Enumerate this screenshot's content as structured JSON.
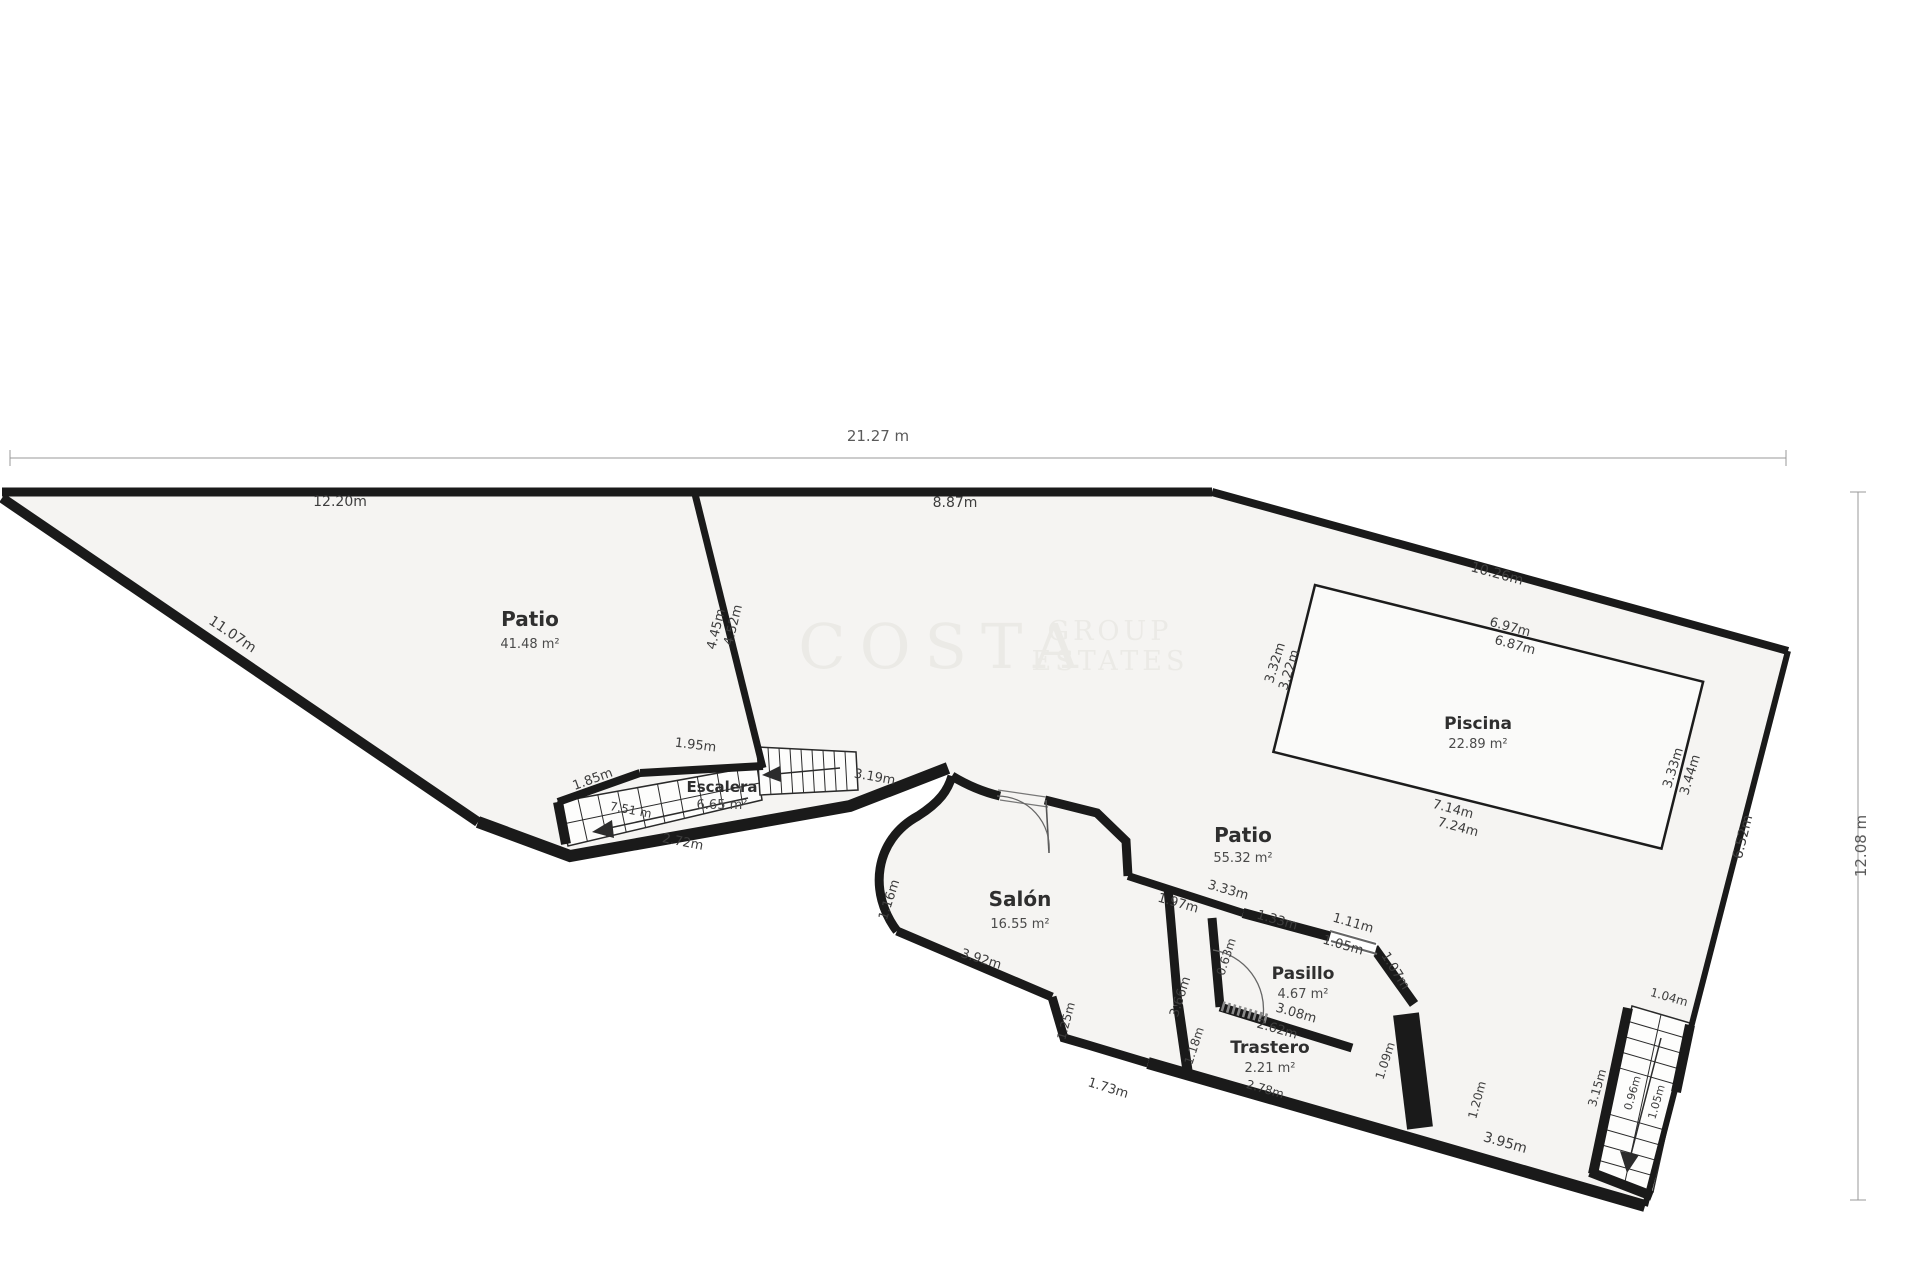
{
  "plan_title": "Planta baja floor plan",
  "dimensions": {
    "top": "21.27 m",
    "right": "12.08 m"
  },
  "colors": {
    "wall": "#1a1a1a",
    "floor": "#f5f4f2",
    "pool_fill": "#fafaf9",
    "stair_fill": "#fdfdfc",
    "label": "#3d3d3d",
    "dim_line": "#999999",
    "watermark": "#ebeae6"
  },
  "watermark": {
    "line1": "COSTA",
    "line2": "GROUP",
    "line3": "ESTATES"
  },
  "rooms": [
    {
      "id": "patio-main",
      "name": "Patio",
      "area": "41.48 m²",
      "x": 530,
      "y": 626,
      "name_size": 20,
      "gap": 22
    },
    {
      "id": "escalera",
      "name": "Escalera",
      "area": "6.65 m²",
      "x": 722,
      "y": 792,
      "name_size": 15,
      "gap": 17
    },
    {
      "id": "salon",
      "name": "Salón",
      "area": "16.55 m²",
      "x": 1020,
      "y": 906,
      "name_size": 20,
      "gap": 22
    },
    {
      "id": "patio-pool",
      "name": "Patio",
      "area": "55.32 m²",
      "x": 1243,
      "y": 842,
      "name_size": 20,
      "gap": 20
    },
    {
      "id": "piscina",
      "name": "Piscina",
      "area": "22.89 m²",
      "x": 1478,
      "y": 729,
      "name_size": 17,
      "gap": 19
    },
    {
      "id": "pasillo",
      "name": "Pasillo",
      "area": "4.67 m²",
      "x": 1303,
      "y": 979,
      "name_size": 17,
      "gap": 19
    },
    {
      "id": "trastero",
      "name": "Trastero",
      "area": "2.21 m²",
      "x": 1270,
      "y": 1053,
      "name_size": 17,
      "gap": 19
    }
  ],
  "labels": [
    {
      "id": "dim-top",
      "text": "21.27 m",
      "x": 878,
      "y": 441,
      "rot": 0,
      "size": 15,
      "cls": "dimtxt"
    },
    {
      "id": "dim-right",
      "text": "12.08 m",
      "x": 1866,
      "y": 846,
      "rot": -90,
      "size": 15,
      "cls": "dimtxt"
    },
    {
      "id": "top-wall-left",
      "text": "12.20m",
      "x": 340,
      "y": 506,
      "rot": 0,
      "size": 14
    },
    {
      "id": "top-wall-right",
      "text": "8.87m",
      "x": 955,
      "y": 507,
      "rot": 0,
      "size": 14
    },
    {
      "id": "left-diagonal",
      "text": "11.07m",
      "x": 230,
      "y": 638,
      "rot": 34,
      "size": 14
    },
    {
      "id": "plot-ne-diagonal",
      "text": "10.26m",
      "x": 1496,
      "y": 578,
      "rot": 15,
      "size": 14
    },
    {
      "id": "right-wall",
      "text": "6.52m",
      "x": 1747,
      "y": 838,
      "rot": -76,
      "size": 14
    },
    {
      "id": "bottom-wall",
      "text": "3.95m",
      "x": 1504,
      "y": 1147,
      "rot": 16,
      "size": 14
    },
    {
      "id": "divider-a",
      "text": "4.52m",
      "x": 737,
      "y": 626,
      "rot": -76,
      "size": 13
    },
    {
      "id": "divider-b",
      "text": "4.45m",
      "x": 720,
      "y": 630,
      "rot": -76,
      "size": 13
    },
    {
      "id": "stairs-top",
      "text": "1.95m",
      "x": 695,
      "y": 749,
      "rot": 7,
      "size": 13
    },
    {
      "id": "stairs-upleft",
      "text": "1.85m",
      "x": 594,
      "y": 783,
      "rot": -20,
      "size": 13
    },
    {
      "id": "stairs-length",
      "text": "7.51 m",
      "x": 630,
      "y": 814,
      "rot": 11,
      "size": 12
    },
    {
      "id": "stairs-lower",
      "text": "2.72m",
      "x": 682,
      "y": 846,
      "rot": 11,
      "size": 13
    },
    {
      "id": "stairs-right",
      "text": "3.19m",
      "x": 874,
      "y": 781,
      "rot": 10,
      "size": 13
    },
    {
      "id": "salon-west",
      "text": "1.16m",
      "x": 893,
      "y": 901,
      "rot": -72,
      "size": 13
    },
    {
      "id": "salon-bottom",
      "text": "3.92m",
      "x": 980,
      "y": 963,
      "rot": 17,
      "size": 13
    },
    {
      "id": "salon-notch-side",
      "text": "1.25m",
      "x": 1070,
      "y": 1022,
      "rot": -75,
      "size": 12
    },
    {
      "id": "salon-notch-bot",
      "text": "1.73m",
      "x": 1107,
      "y": 1092,
      "rot": 17,
      "size": 13
    },
    {
      "id": "salon-ne-1",
      "text": "1.97m",
      "x": 1177,
      "y": 907,
      "rot": 16,
      "size": 13
    },
    {
      "id": "salon-ne-2",
      "text": "3.33m",
      "x": 1227,
      "y": 894,
      "rot": 16,
      "size": 13
    },
    {
      "id": "salon-east",
      "text": "3.66m",
      "x": 1184,
      "y": 998,
      "rot": -72,
      "size": 13
    },
    {
      "id": "trastero-west",
      "text": "1.18m",
      "x": 1198,
      "y": 1047,
      "rot": -72,
      "size": 12
    },
    {
      "id": "pasillo-north",
      "text": "1.33m",
      "x": 1276,
      "y": 924,
      "rot": 16,
      "size": 13
    },
    {
      "id": "pasillo-window-a",
      "text": "1.11m",
      "x": 1352,
      "y": 927,
      "rot": 16,
      "size": 13
    },
    {
      "id": "pasillo-window-b",
      "text": "1.05m",
      "x": 1342,
      "y": 949,
      "rot": 16,
      "size": 13
    },
    {
      "id": "pasillo-ne",
      "text": "1.07m",
      "x": 1392,
      "y": 973,
      "rot": 58,
      "size": 13
    },
    {
      "id": "pasillo-west",
      "text": "0.63m",
      "x": 1230,
      "y": 958,
      "rot": -72,
      "size": 12
    },
    {
      "id": "pasillo-south",
      "text": "3.08m",
      "x": 1295,
      "y": 1017,
      "rot": 16,
      "size": 13
    },
    {
      "id": "trastero-north",
      "text": "2.62m",
      "x": 1276,
      "y": 1033,
      "rot": 16,
      "size": 13
    },
    {
      "id": "trastero-width",
      "text": "2.78m",
      "x": 1264,
      "y": 1093,
      "rot": 16,
      "size": 12
    },
    {
      "id": "trastero-east",
      "text": "1.09m",
      "x": 1389,
      "y": 1062,
      "rot": -72,
      "size": 12
    },
    {
      "id": "patio-seg",
      "text": "1.20m",
      "x": 1481,
      "y": 1101,
      "rot": -75,
      "size": 12
    },
    {
      "id": "stairs2-top",
      "text": "1.04m",
      "x": 1668,
      "y": 1001,
      "rot": 16,
      "size": 12
    },
    {
      "id": "stairs2-left",
      "text": "3.15m",
      "x": 1601,
      "y": 1089,
      "rot": -74,
      "size": 12
    },
    {
      "id": "stairs2-in-a",
      "text": "0.96m",
      "x": 1636,
      "y": 1094,
      "rot": -74,
      "size": 11
    },
    {
      "id": "stairs2-in-b",
      "text": "1.05m",
      "x": 1660,
      "y": 1103,
      "rot": -74,
      "size": 11
    },
    {
      "id": "pool-top-a",
      "text": "6.97m",
      "x": 1509,
      "y": 631,
      "rot": 15,
      "size": 13
    },
    {
      "id": "pool-top-b",
      "text": "6.87m",
      "x": 1514,
      "y": 649,
      "rot": 15,
      "size": 13
    },
    {
      "id": "pool-left-a",
      "text": "3.32m",
      "x": 1279,
      "y": 664,
      "rot": -73,
      "size": 13
    },
    {
      "id": "pool-left-b",
      "text": "3.22m",
      "x": 1293,
      "y": 671,
      "rot": -73,
      "size": 13
    },
    {
      "id": "pool-bottom-a",
      "text": "7.14m",
      "x": 1452,
      "y": 813,
      "rot": 15,
      "size": 13
    },
    {
      "id": "pool-bottom-b",
      "text": "7.24m",
      "x": 1457,
      "y": 831,
      "rot": 15,
      "size": 13
    },
    {
      "id": "pool-right-a",
      "text": "3.33m",
      "x": 1677,
      "y": 769,
      "rot": -73,
      "size": 13
    },
    {
      "id": "pool-right-b",
      "text": "3.44m",
      "x": 1694,
      "y": 776,
      "rot": -73,
      "size": 13
    }
  ]
}
